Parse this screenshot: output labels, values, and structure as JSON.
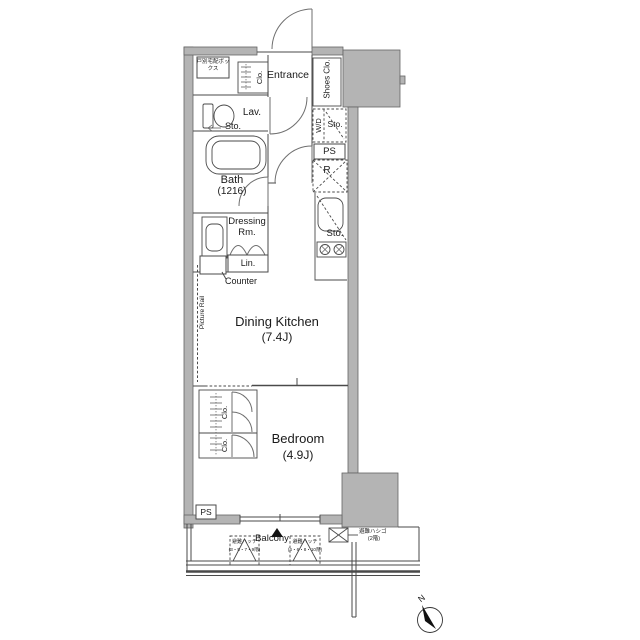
{
  "colors": {
    "wall": "#b4b4b4",
    "line": "#4a4a4a",
    "text": "#1a1a1a",
    "accent_black": "#111111"
  },
  "rooms": {
    "entrance": "Entrance",
    "dining_kitchen": "Dining Kitchen",
    "dining_kitchen_size": "(7.4J)",
    "bedroom": "Bedroom",
    "bedroom_size": "(4.9J)",
    "bath": "Bath",
    "bath_size": "(1216)",
    "dressing_room": "Dressing Rm.",
    "lavatory": "Lav.",
    "balcony": "Balcony"
  },
  "fixtures": {
    "delivery_box": "戸別宅配ボックス",
    "entrance_closet": "Clo.",
    "shoes_closet": "Shoes Clo.",
    "lavatory_storage": "Sto.",
    "washer_dryer": "W/D",
    "wd_storage": "Sto.",
    "pipe_space_top": "PS",
    "refrigerator": "R",
    "kitchen_storage": "Sto.",
    "linen_closet": "Lin.",
    "counter": "Counter",
    "picture_rail": "Picture Rail",
    "bedroom_closet_upper": "Clo.",
    "bedroom_closet_lower": "Clo.",
    "pipe_space_bottom": "PS"
  },
  "evacuation": {
    "hatch1_name": "避難ハッチ",
    "hatch1_floors": "(3・5・7・9階)",
    "hatch2_name": "避難ハッチ",
    "hatch2_floors": "(4・6・8・10階)",
    "ladder_name": "避難ハシゴ",
    "ladder_floors": "(2階)"
  },
  "compass": {
    "north_label": "N"
  },
  "icons": {
    "balcony_marker": "▲",
    "north_arrow": "compass-needle"
  }
}
